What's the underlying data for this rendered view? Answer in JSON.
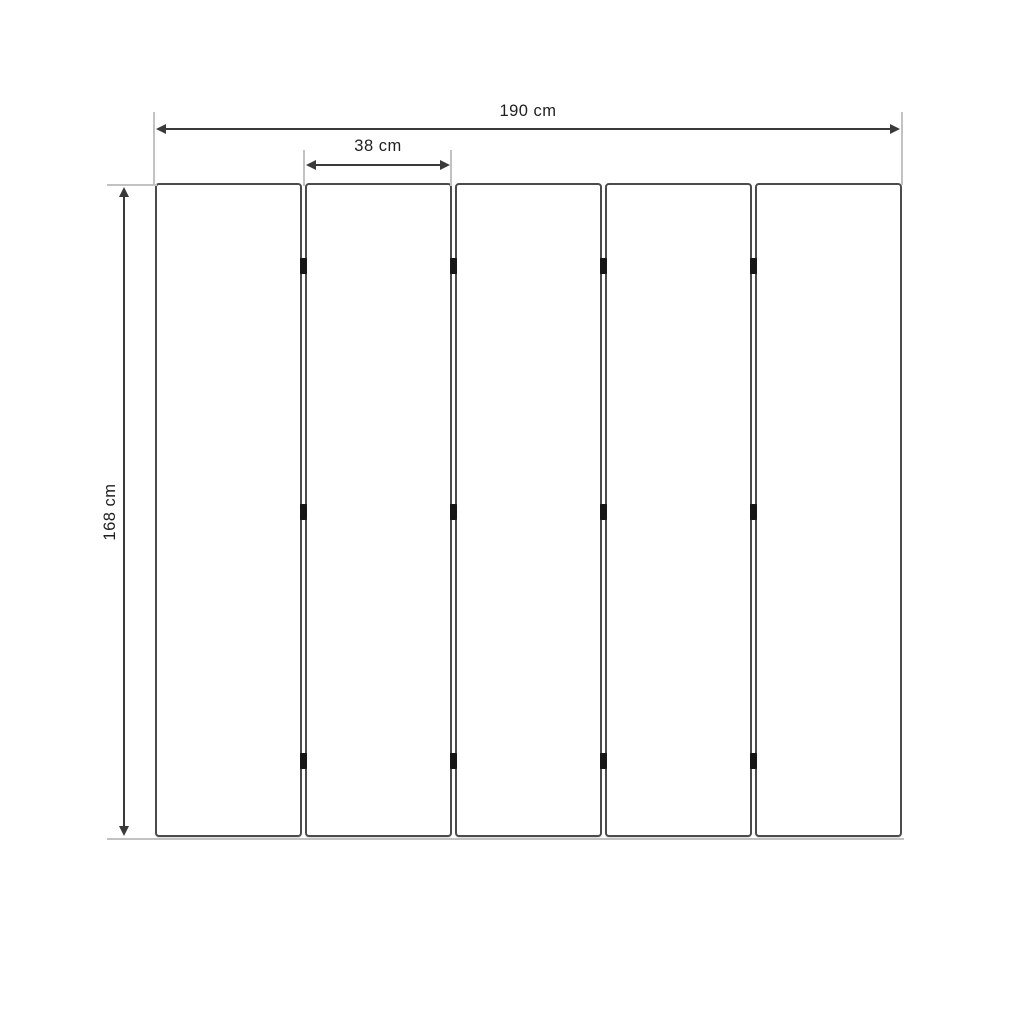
{
  "diagram": {
    "panel_count": 5,
    "hinge_rows_per_gap": 3,
    "dimensions": {
      "total_width": {
        "label": "190 cm",
        "value": 190,
        "unit": "cm"
      },
      "panel_width": {
        "label": "38 cm",
        "value": 38,
        "unit": "cm"
      },
      "height": {
        "label": "168 cm",
        "value": 168,
        "unit": "cm"
      }
    },
    "colors": {
      "background": "#ffffff",
      "panel_border": "#4b4b4b",
      "panel_fill": "#ffffff",
      "dimension_line": "#3a3a3a",
      "extension_line": "#c2c2c2",
      "hinge": "#161616",
      "label_text": "#1f1f1f"
    }
  }
}
